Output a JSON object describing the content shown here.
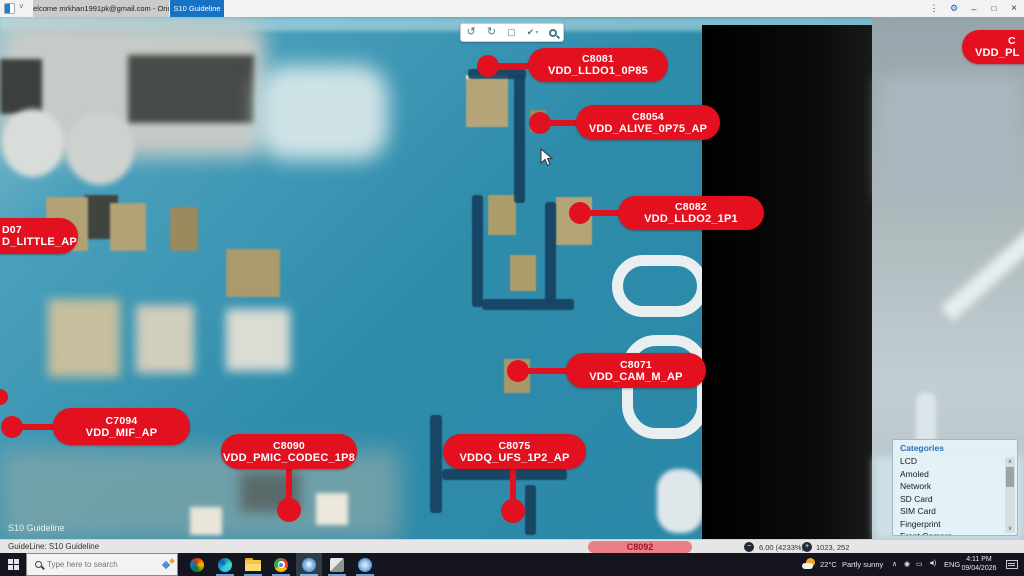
{
  "window": {
    "tabs": [
      {
        "label": "Welcome mrkhan1991pk@gmail.com - Orion"
      },
      {
        "label": "S10 Guideline"
      }
    ]
  },
  "icons": {
    "tab_caret": "˅",
    "menu": "⋮",
    "settings": "⚙",
    "minimize": "–",
    "maximize": "□",
    "close": "×",
    "rotate_left": "↺",
    "rotate_right": "↻",
    "fit_screen": "▢",
    "draw_check": "✔",
    "caret_down": "▾",
    "chevron_up": "∧",
    "scroll_up": "∧",
    "scroll_down": "∨",
    "tray_circle": "◉",
    "tray_monitor": "▭",
    "tray_speaker": "◄)",
    "zoom_out": "−",
    "zoom_in": "+"
  },
  "callouts": [
    {
      "id": "C8081",
      "rail": "VDD_LLDO1_0P85"
    },
    {
      "id": "C8054",
      "rail": "VDD_ALIVE_0P75_AP"
    },
    {
      "id": "C8082",
      "rail": "VDD_LLDO2_1P1"
    },
    {
      "id": "C8071",
      "rail": "VDD_CAM_M_AP"
    },
    {
      "id": "C7094",
      "rail": "VDD_MIF_AP"
    },
    {
      "id": "C8090",
      "rail": "VDD_PMIC_CODEC_1P8"
    },
    {
      "id": "C8075",
      "rail": "VDDQ_UFS_1P2_AP"
    },
    {
      "id": "D07",
      "rail": "D_LITTLE_AP"
    },
    {
      "id": "C",
      "rail": "VDD_PL"
    },
    {
      "id": "C8092",
      "rail": ""
    }
  ],
  "watermark": "S10 Guideline",
  "categories": {
    "title": "Categories",
    "items": [
      "LCD",
      "Amoled",
      "Network",
      "SD Card",
      "SIM Card",
      "Fingerprint",
      "Front Camera"
    ]
  },
  "statusbar": {
    "left": "GuideLine: S10 Guideline",
    "zoom_value": "6.00 (4233%)",
    "coords": "1023, 252"
  },
  "taskbar": {
    "search_placeholder": "Type here to search",
    "weather_temp": "22°C",
    "weather_desc": "Partly sunny",
    "language": "ENG",
    "time": "4:11 PM",
    "date": "09/04/2026"
  },
  "colors": {
    "callout_red": "#e3101f",
    "active_tab_blue": "#1673c4",
    "pcb_teal": "#2e8cab"
  }
}
